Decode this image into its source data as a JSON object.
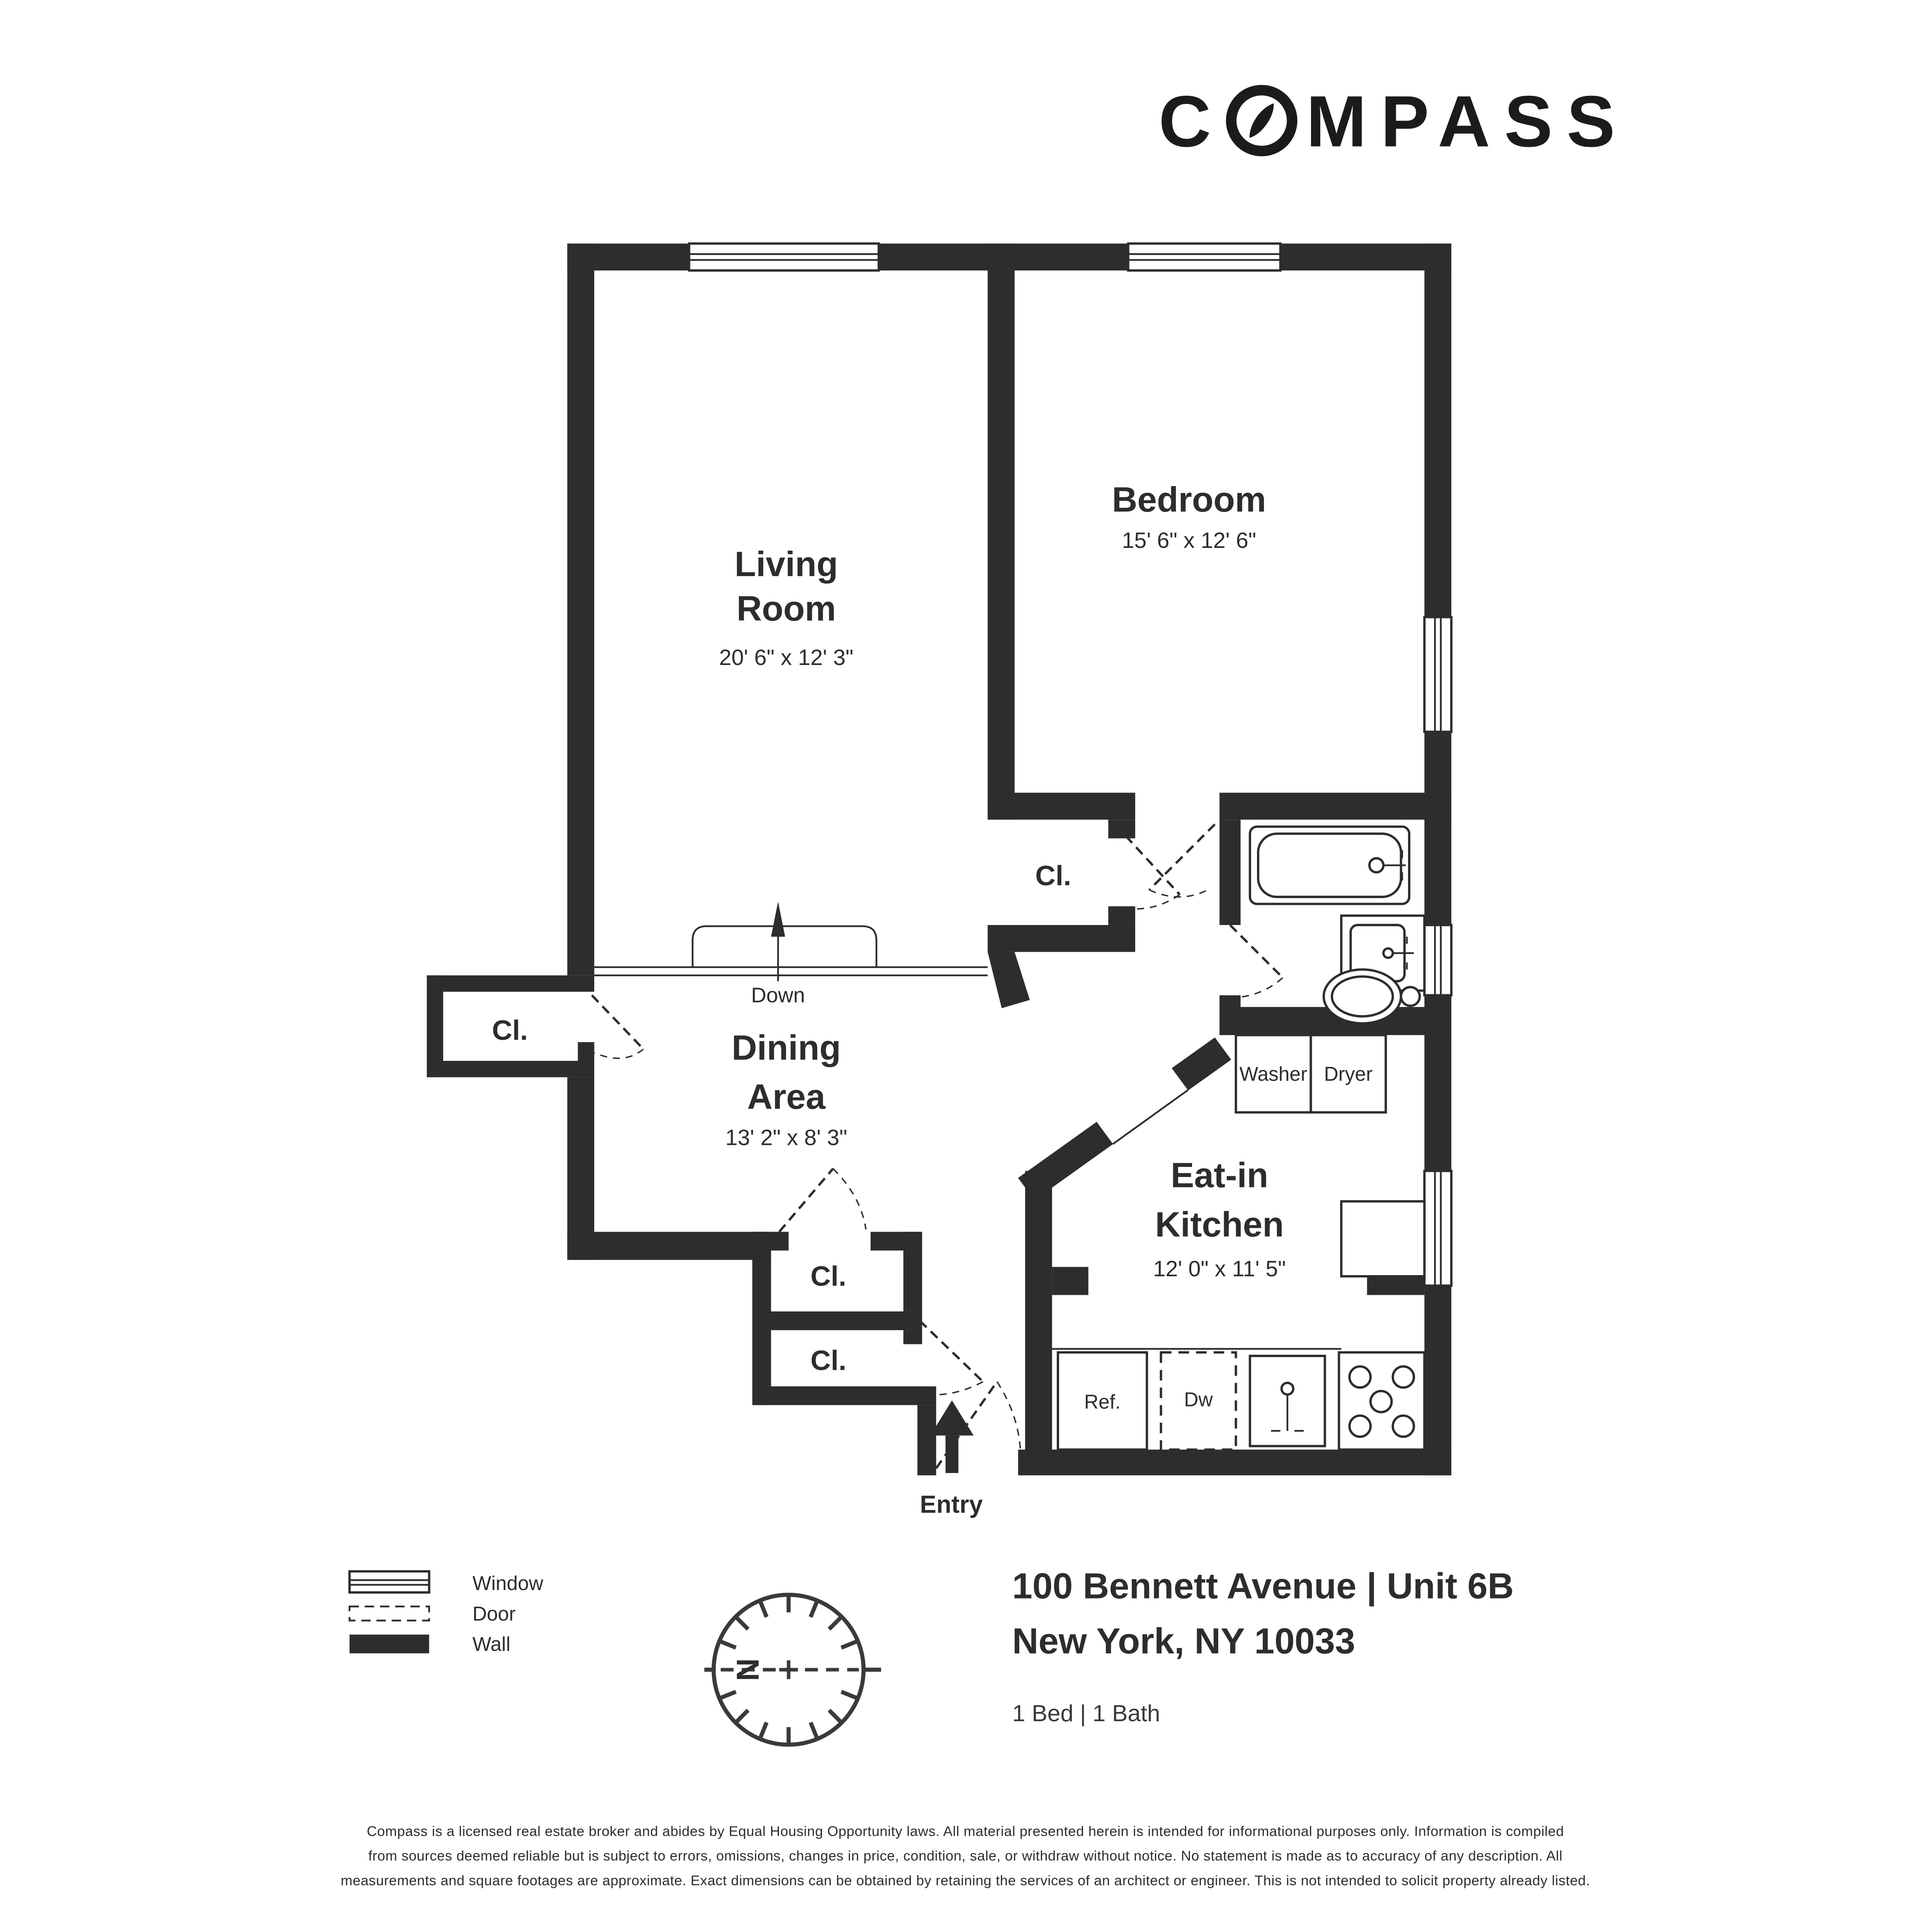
{
  "logo": {
    "prefix": "C",
    "suffix": "MPASS",
    "full": "COMPASS"
  },
  "rooms": {
    "living": {
      "name_line1": "Living",
      "name_line2": "Room",
      "dims": "20' 6\" x 12' 3\""
    },
    "bedroom": {
      "name": "Bedroom",
      "dims": "15' 6\" x 12' 6\""
    },
    "dining": {
      "name_line1": "Dining",
      "name_line2": "Area",
      "dims": "13' 2\" x 8' 3\""
    },
    "kitchen": {
      "name_line1": "Eat-in",
      "name_line2": "Kitchen",
      "dims": "12' 0\" x 11' 5\""
    }
  },
  "labels": {
    "closet": "Cl.",
    "washer": "Washer",
    "dryer": "Dryer",
    "refrigerator": "Ref.",
    "dishwasher": "Dw",
    "down": "Down",
    "entry": "Entry",
    "north": "N"
  },
  "legend": {
    "window": "Window",
    "door": "Door",
    "wall": "Wall"
  },
  "address": {
    "line1": "100 Bennett Avenue | Unit 6B",
    "line2": "New York, NY 10033",
    "beds_baths": "1 Bed | 1 Bath"
  },
  "disclaimer": [
    "Compass is a licensed real estate broker and abides by Equal Housing Opportunity laws. All material presented herein is intended for informational purposes only. Information is compiled",
    "from sources deemed reliable but is subject to errors, omissions, changes in price, condition, sale, or withdraw without notice. No statement is made as to accuracy of any description. All",
    "measurements and square footages are approximate. Exact dimensions can be obtained by retaining the services of an architect or engineer. This is not intended to solicit property already listed."
  ],
  "colors": {
    "wall": "#2e2d2c",
    "text": "#2e2d2c",
    "logo": "#1b1b1b",
    "background": "#ffffff"
  }
}
